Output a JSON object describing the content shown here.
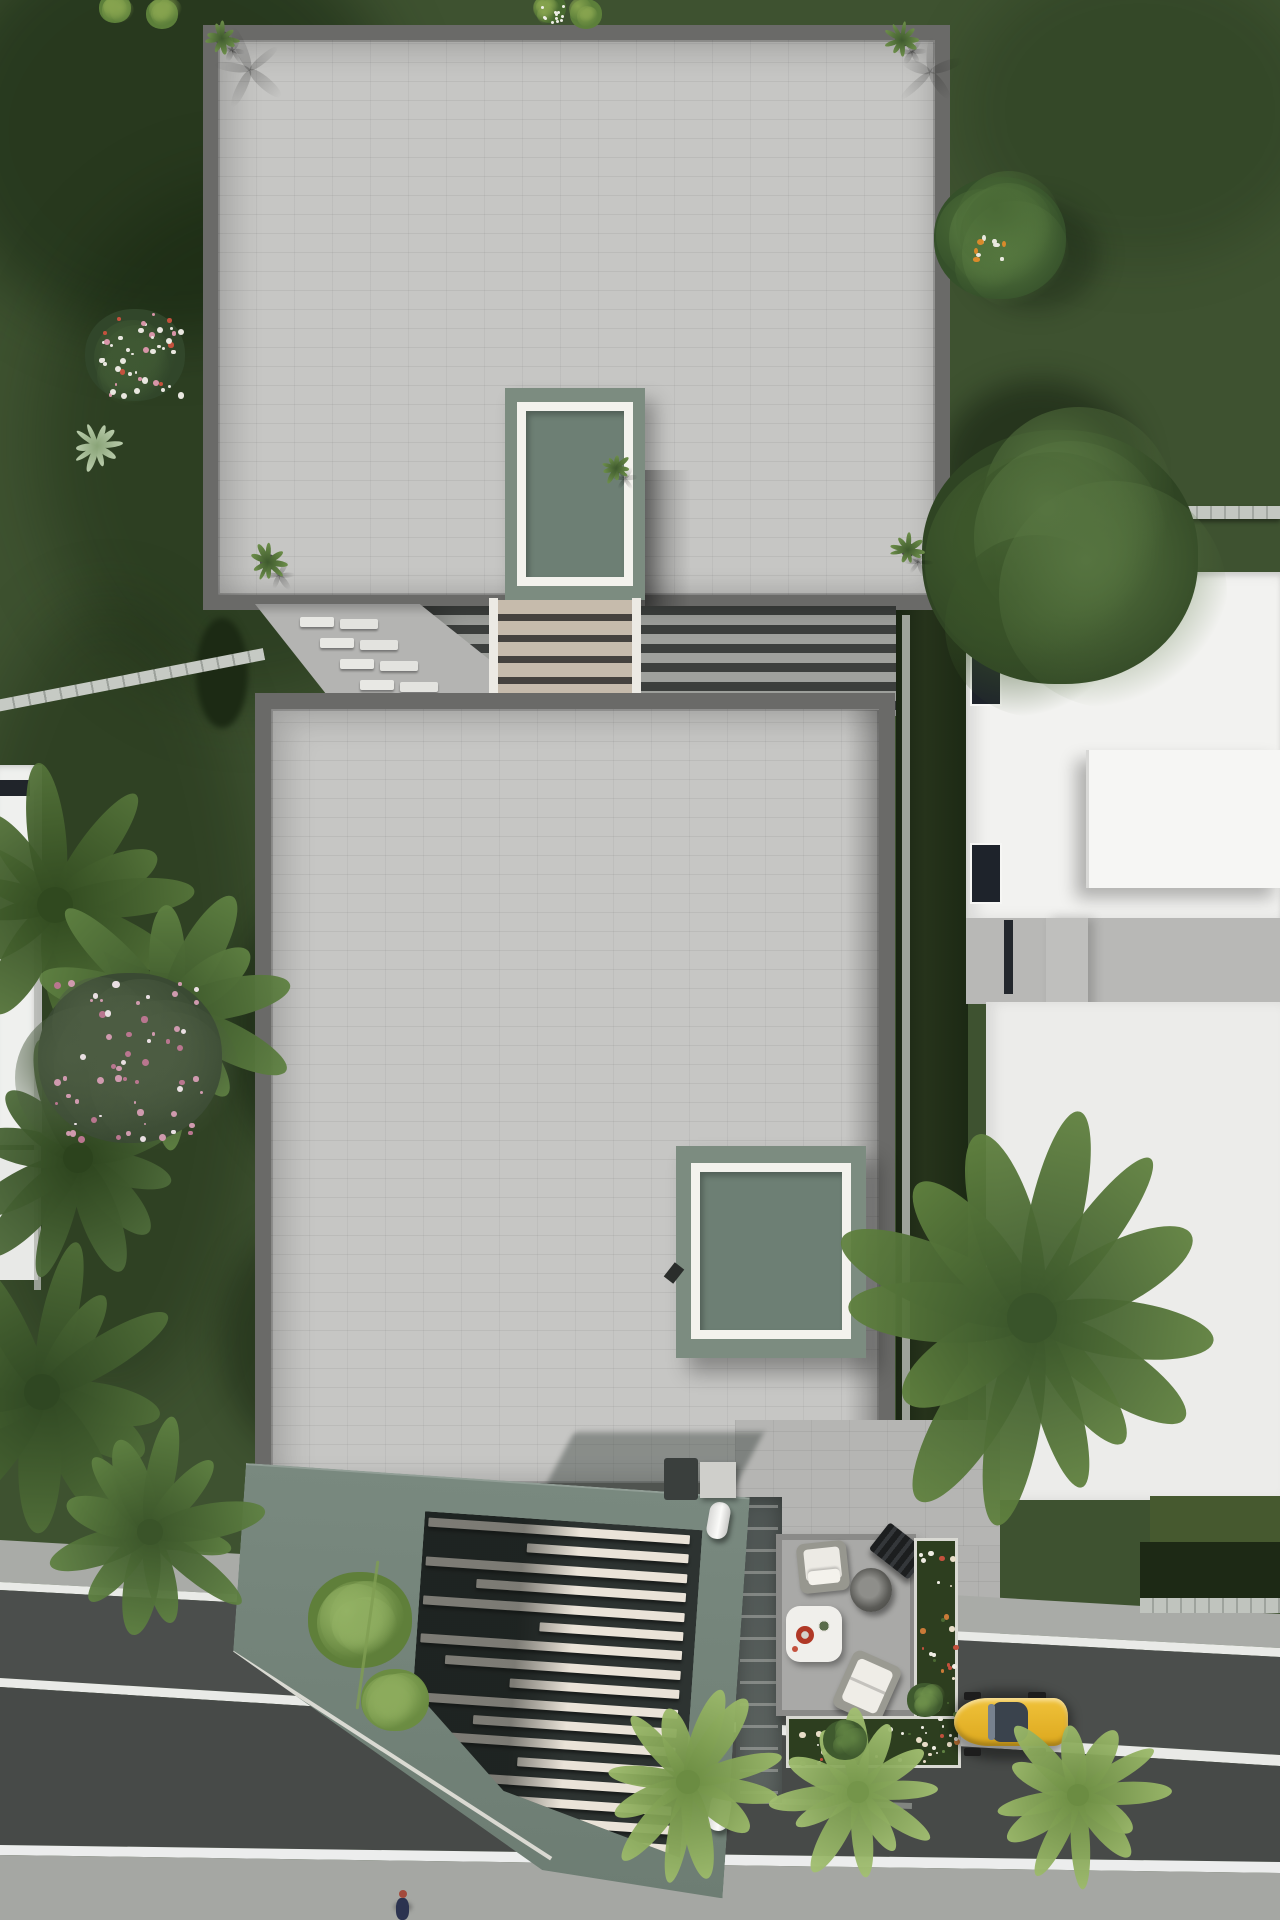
{
  "scene": {
    "type": "3d-architectural-render-top-view",
    "title": "Top-down render of a modern two-block villa with roof skylights, pergola stairs, sage carport gate, street-side patio and parked yellow car",
    "palette": {
      "grass": "#3e5230",
      "grass_dark": "#2c3f20",
      "grass_light": "#4c6136",
      "roof_paving": "#c6c6c4",
      "roof_border": "#6a6a68",
      "skylight_base_sage": "#7c8c80",
      "skylight_frame_white": "#f3f2ed",
      "skylight_glass_green": "#6d7f74",
      "gate_sage": "#75857b",
      "gate_recess_dark": "#2d3331",
      "gate_slat_cream": "#eae3d8",
      "stair_tread_beige": "#c6bbac",
      "pergola_gap_dark": "#3c3f3d",
      "asphalt": "#4b4e4c",
      "sidewalk": "#a7a9a5",
      "lane_line_white": "#e9eae7",
      "hedge_dark": "#222e1a",
      "fence_light": "#b9bcb6",
      "neighbor_building_white": "#f2f2f0",
      "neighbor_gray_band": "#b8b8b6",
      "flower_bed_green": "#2d3e1f",
      "flower_white": "#efece3",
      "flower_red": "#c4513d",
      "palm_dark": "#3a5429",
      "palm_mid": "#4e6b3a",
      "palm_bright": "#8cab5c",
      "blossom_pink": "#cf9aae",
      "car_yellow": "#e5b52a",
      "car_canopy": "#3a434d",
      "patio_slab": "#a9a9a7",
      "coffee_table_white": "#f0efeb",
      "bowl_red": "#b03826"
    },
    "objects": [
      {
        "name": "upper-roof",
        "label": "upper block flat roof with tile paving and four corner planters"
      },
      {
        "name": "upper-skylight",
        "label": "sage skylight with white frame on upper roof"
      },
      {
        "name": "pergola-stairs",
        "label": "louvered pergola and staircase between the two blocks"
      },
      {
        "name": "lower-roof",
        "label": "lower block flat roof with tile paving"
      },
      {
        "name": "lower-skylight",
        "label": "sage skylight with white frame on lower roof"
      },
      {
        "name": "carport-gate",
        "label": "tilted sage carport gate with staggered cream louvers and two white hinges"
      },
      {
        "name": "street-patio",
        "label": "ground patio with lounge chairs, round wicker table, white coffee table"
      },
      {
        "name": "flower-bed",
        "label": "L-shaped flower bed with white and red blooms"
      },
      {
        "name": "yellow-car",
        "label": "yellow sports car parked on the street"
      },
      {
        "name": "road",
        "label": "asphalt road with three white lines and sidewalks"
      },
      {
        "name": "right-neighbor",
        "label": "white modern neighbor house with hedge and fence"
      },
      {
        "name": "left-neighbor",
        "label": "left neighbor plot with palms and pink blossom tree"
      },
      {
        "name": "pedestrian",
        "label": "tiny pedestrian at bottom sidewalk"
      }
    ],
    "counts": {
      "gate_slats": 17,
      "stair_tread_pairs": 5,
      "road_lane_lines": 3,
      "skylights": 2,
      "roof_planters": 5
    }
  }
}
